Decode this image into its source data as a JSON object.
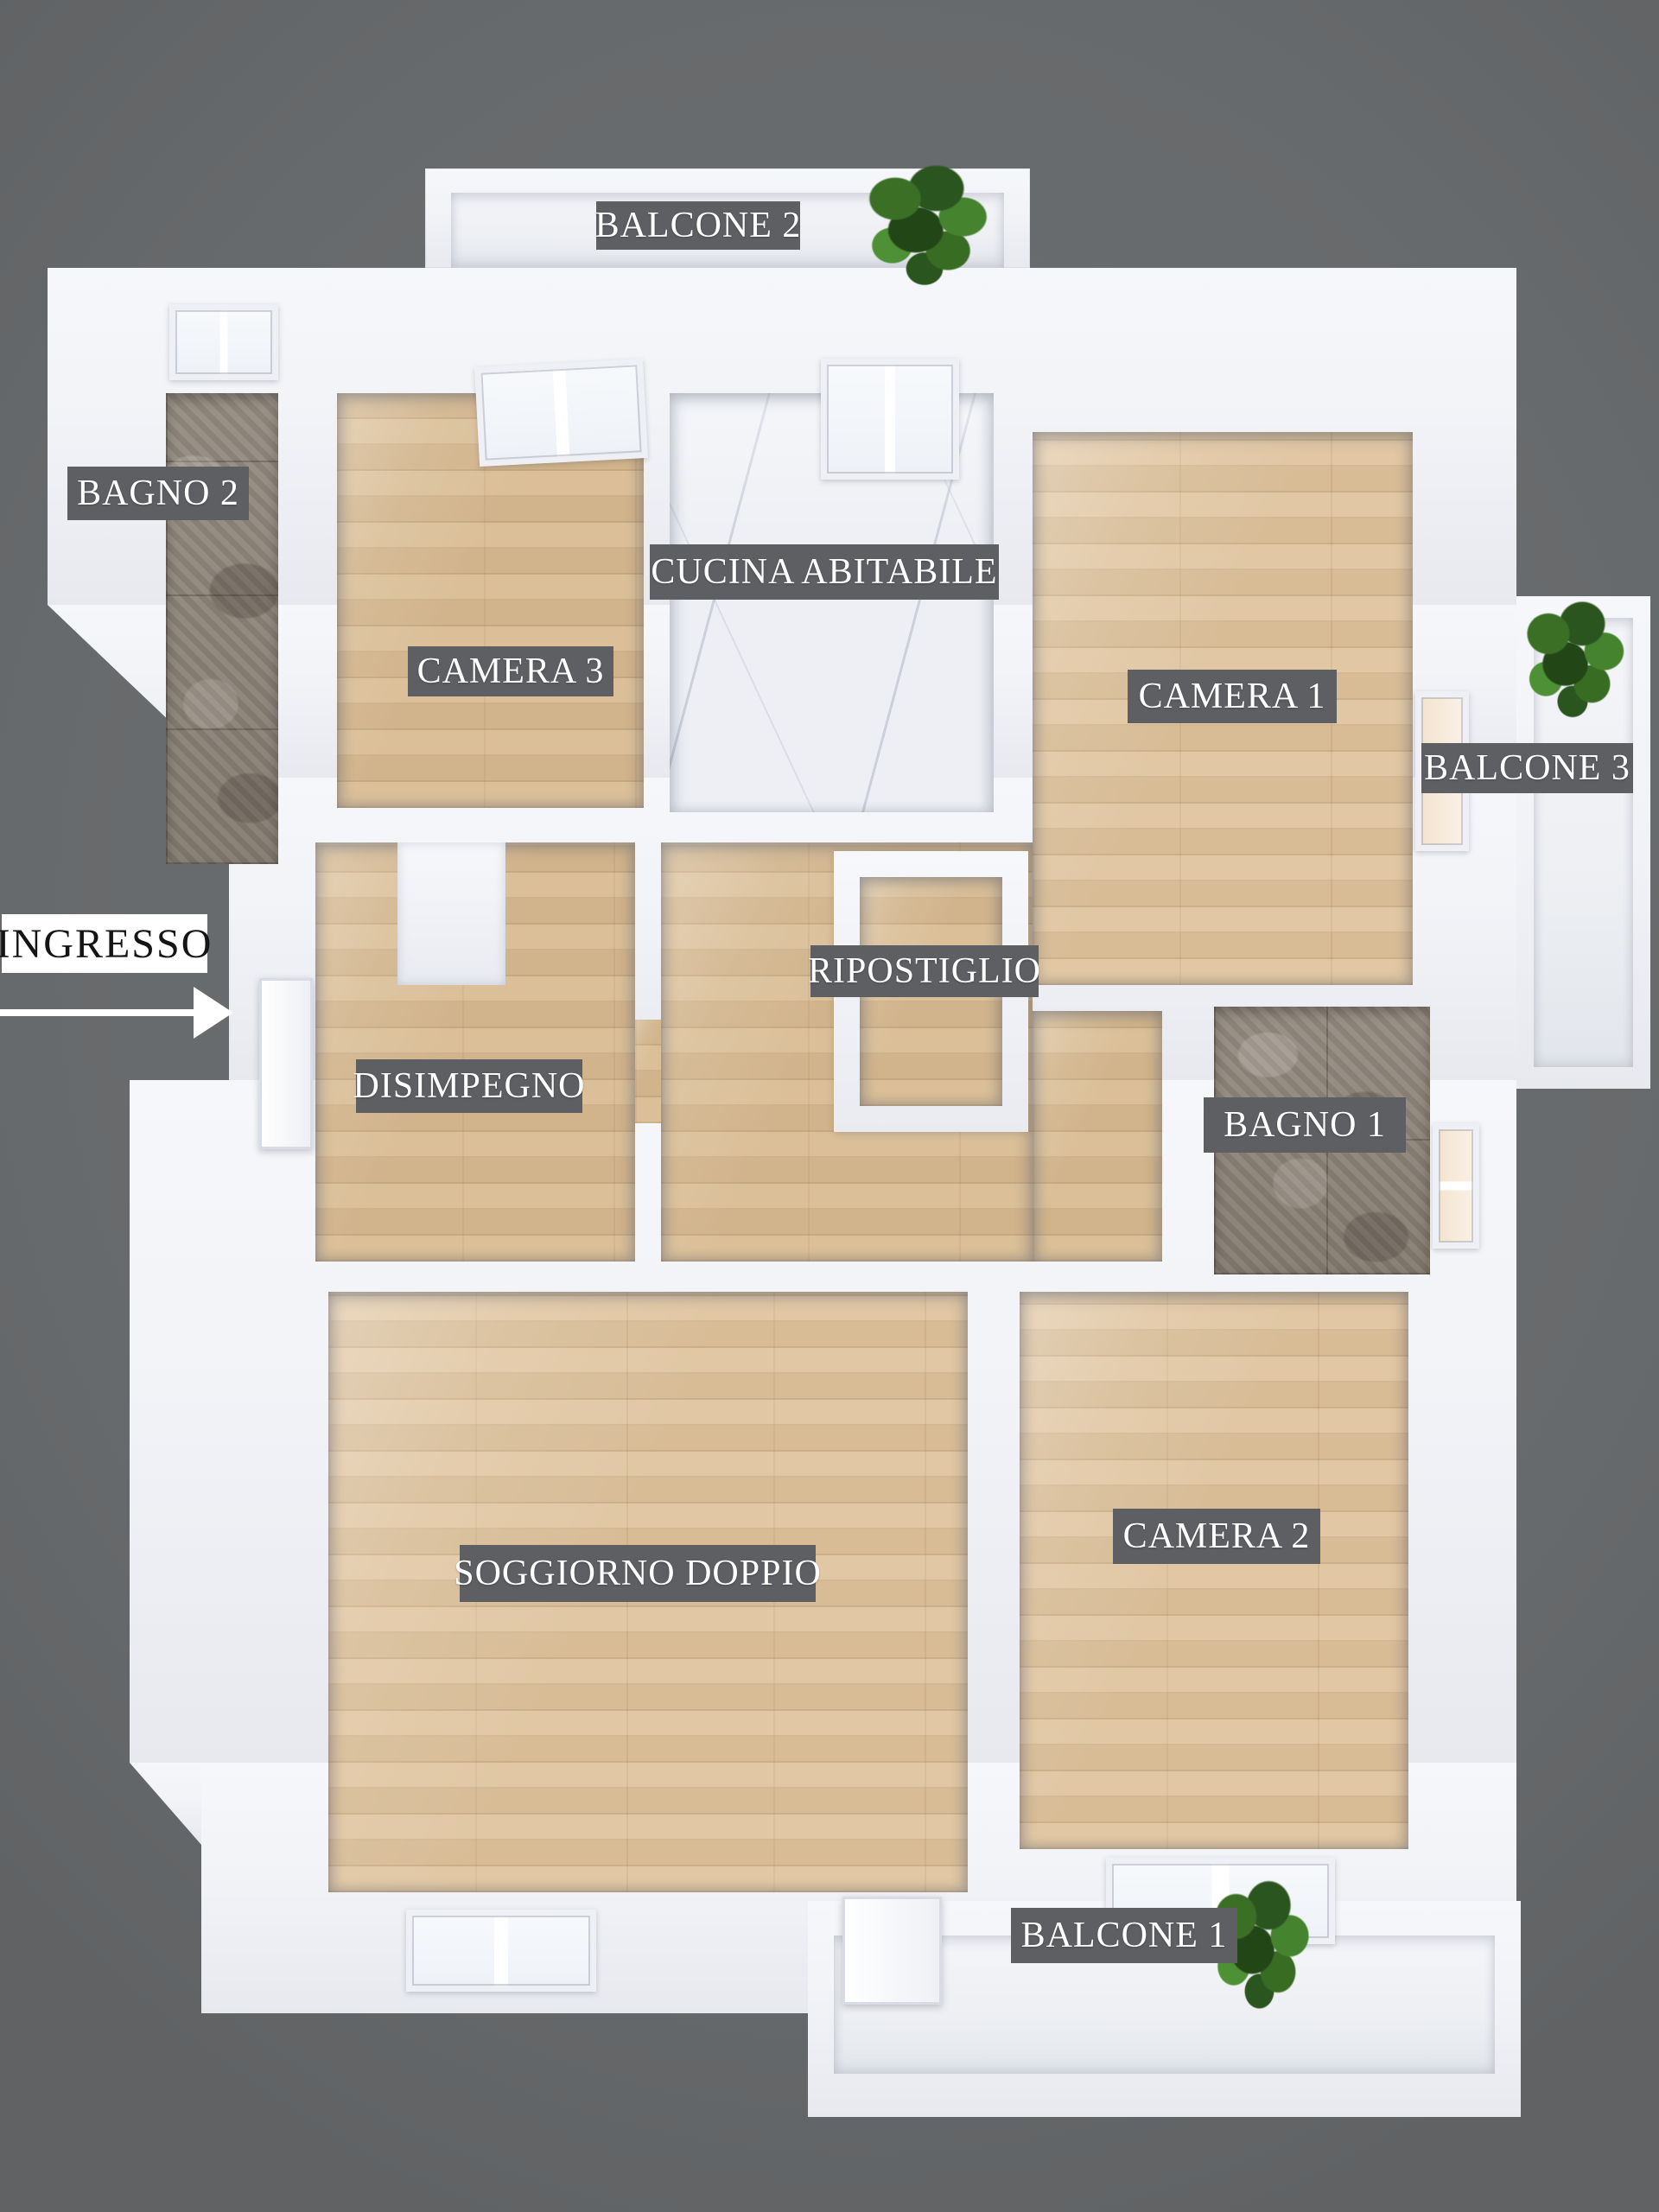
{
  "title": "Apartment floor plan (3D top view)",
  "colors": {
    "background": "#676a6c",
    "wall": "#f1f3f7",
    "label_bg": "#5d5f63",
    "label_text": "#ffffff",
    "wood": "#d8bb92",
    "wood_light": "#dfc49e",
    "marble": "#edeff4",
    "tile_dark": "#847b70",
    "tile_light": "#958c81",
    "balcony_floor": "#edeff3",
    "glass": "#f7f9fc",
    "glass_warm": "#f4e4cf",
    "plant": "#3a6b26",
    "entrance_bg": "#ffffff",
    "entrance_text": "#141414"
  },
  "rooms": [
    {
      "id": "balcone-2",
      "label": "BALCONE 2",
      "floor": "balcony"
    },
    {
      "id": "bagno-2",
      "label": "BAGNO 2",
      "floor": "tile"
    },
    {
      "id": "camera-3",
      "label": "CAMERA 3",
      "floor": "wood"
    },
    {
      "id": "cucina",
      "label": "CUCINA ABITABILE",
      "floor": "marble"
    },
    {
      "id": "camera-1",
      "label": "CAMERA 1",
      "floor": "wood"
    },
    {
      "id": "balcone-3",
      "label": "BALCONE 3",
      "floor": "balcony"
    },
    {
      "id": "disimpegno",
      "label": "DISIMPEGNO",
      "floor": "wood"
    },
    {
      "id": "ripostiglio",
      "label": "RIPOSTIGLIO",
      "floor": "wood"
    },
    {
      "id": "bagno-1",
      "label": "BAGNO 1",
      "floor": "tile"
    },
    {
      "id": "soggiorno",
      "label": "SOGGIORNO DOPPIO",
      "floor": "wood"
    },
    {
      "id": "camera-2",
      "label": "CAMERA 2",
      "floor": "wood"
    },
    {
      "id": "balcone-1",
      "label": "BALCONE 1",
      "floor": "balcony"
    }
  ],
  "entrance": {
    "label": "INGRESSO",
    "arrow_icon": "right-arrow"
  }
}
